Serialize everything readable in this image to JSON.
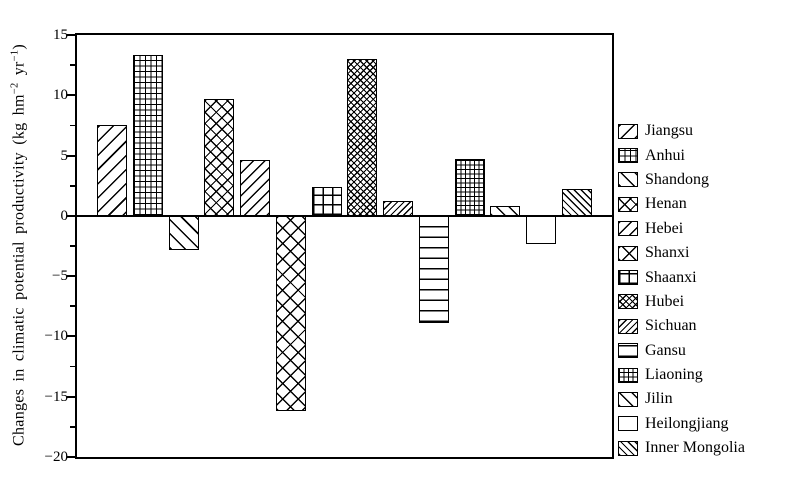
{
  "chart_data": {
    "type": "bar",
    "title": "",
    "ylabel": "Changes in climatic potential productivity (kg hm−2 yr−1)",
    "ylabel_parts": {
      "prefix": "Changes in climatic potential productivity (kg hm",
      "sup1": "−2",
      "mid": " yr",
      "sup2": "−1",
      "suffix": ")"
    },
    "xlabel": "",
    "ylim": [
      -20,
      15
    ],
    "grid": false,
    "legend_position": "right",
    "yticks": [
      {
        "value": 15,
        "label": "15"
      },
      {
        "value": 10,
        "label": "10"
      },
      {
        "value": 5,
        "label": "5"
      },
      {
        "value": 0,
        "label": "0"
      },
      {
        "value": -5,
        "label": "−5"
      },
      {
        "value": -10,
        "label": "−10"
      },
      {
        "value": -15,
        "label": "−15"
      },
      {
        "value": -20,
        "label": "−20"
      }
    ],
    "ytick_minor_step": 2.5,
    "categories": [
      "Jiangsu",
      "Anhui",
      "Shandong",
      "Henan",
      "Hebei",
      "Shanxi",
      "Shaanxi",
      "Hubei",
      "Sichuan",
      "Gansu",
      "Liaoning",
      "Jilin",
      "Heilongjiang",
      "Inner Mongolia"
    ],
    "values": [
      7.5,
      13.3,
      -2.8,
      9.7,
      4.6,
      -16.2,
      2.4,
      13.0,
      1.2,
      -8.9,
      4.7,
      0.8,
      -2.3,
      2.2
    ],
    "patterns": [
      "diag-f-wide",
      "grid-fine",
      "diag-b-wide",
      "cross-med",
      "diag-f-med",
      "cross-wide",
      "grid-wide",
      "cross-dense",
      "diag-f-dense",
      "horiz",
      "grid-dense",
      "diag-b-med",
      "plain",
      "diag-b-dense"
    ],
    "colors": {
      "ink": "#000000",
      "background": "#ffffff"
    }
  }
}
